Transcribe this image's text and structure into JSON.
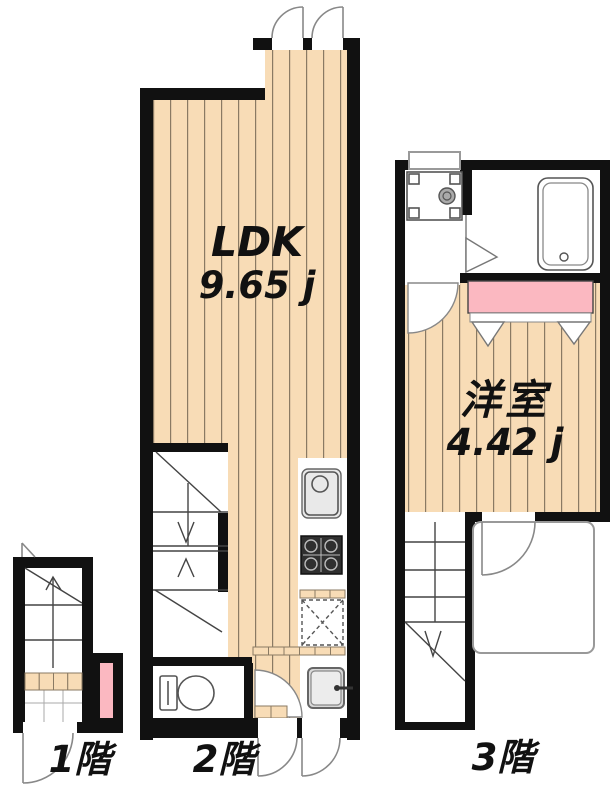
{
  "colors": {
    "wall": "#111111",
    "flooring": "#f8dcb6",
    "flooring_stripe": "#8a7a63",
    "pink_accent": "#fbb8c1",
    "fixture_line": "#555555",
    "door_arc": "#888888",
    "background": "#ffffff"
  },
  "floors": {
    "f1": {
      "label": "1階",
      "fixtures": [
        "staircase-up",
        "entrance-tiles",
        "entrance-door",
        "pink-shelf"
      ]
    },
    "f2": {
      "label": "2階",
      "room": {
        "name": "LDK",
        "area": "9.65 j"
      },
      "fixtures": [
        "entrance-doors",
        "staircase",
        "toilet",
        "kitchen-sink",
        "gas-stove",
        "refrigerator-space",
        "washbasin",
        "rear-doors"
      ]
    },
    "f3": {
      "label": "3階",
      "room": {
        "name": "洋室",
        "area": "4.42 j"
      },
      "fixtures": [
        "washing-machine-pan",
        "bathtub",
        "folding-door",
        "closet-hanger",
        "balcony",
        "staircase-down"
      ]
    }
  }
}
